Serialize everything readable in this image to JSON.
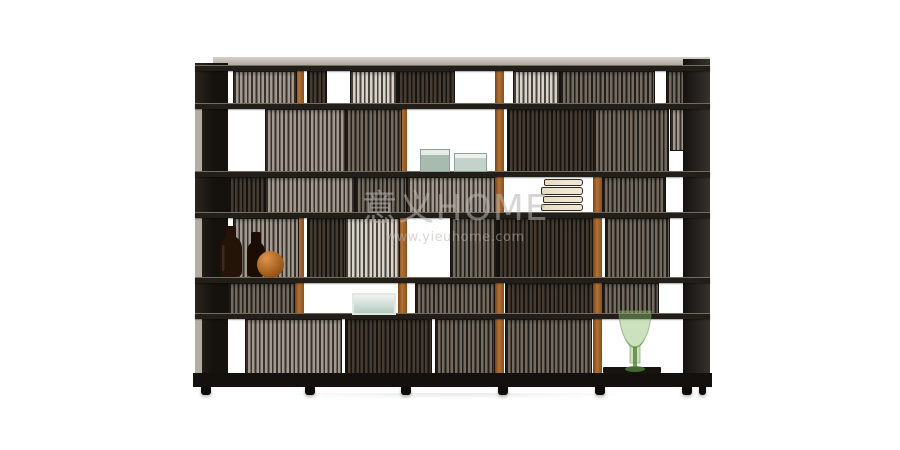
{
  "scene": {
    "type": "product-photo",
    "subject": "dark slatted-wood modular shelving room divider with cognac leather posts",
    "background": "#ffffff"
  },
  "watermark": {
    "line1": "意义HOME",
    "line2": "www.yieuhome.com"
  },
  "palette": {
    "leather": "#b5712f",
    "wood": "#221e1a",
    "teal": "#a7bbb1",
    "green": "#8fbf6e",
    "amber": "#241307",
    "paper": "#efe6d4",
    "wm": "#b9b6b1"
  },
  "decor": {
    "items": [
      "amber bottle",
      "amber bottle",
      "wooden sphere",
      "teal storage box",
      "teal storage box",
      "stack of books",
      "glass box",
      "green glass vase",
      "dark mat"
    ]
  }
}
